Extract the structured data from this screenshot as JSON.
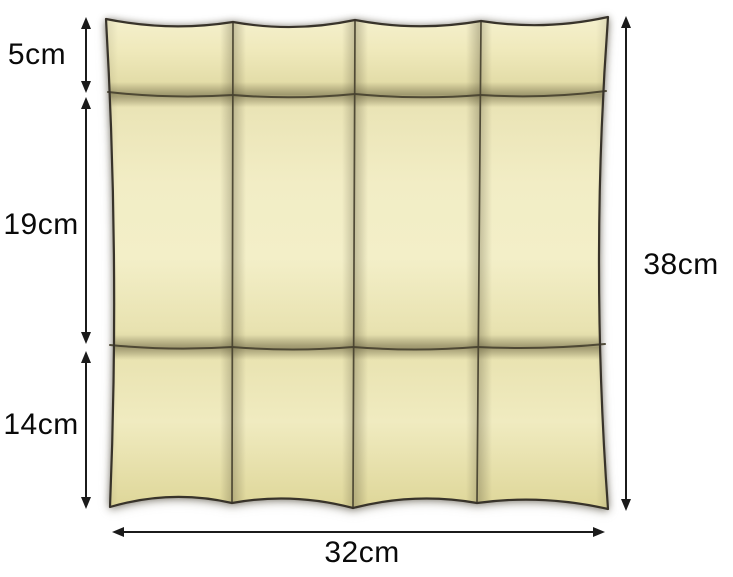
{
  "figure": {
    "background_color": "#ffffff",
    "panel": {
      "columns": 4,
      "rows": 3,
      "fill_color": "#efe9bc",
      "highlight_color": "#f7f3d4",
      "shade_color": "#d9d29c",
      "outline_color": "#38332a"
    },
    "dimensions": {
      "arrow_color": "#1b1b1b",
      "text_color": "#0a0a0a",
      "left": [
        {
          "label": "5cm"
        },
        {
          "label": "19cm"
        },
        {
          "label": "14cm"
        }
      ],
      "right": {
        "label": "38cm"
      },
      "bottom": {
        "label": "32cm"
      }
    }
  }
}
